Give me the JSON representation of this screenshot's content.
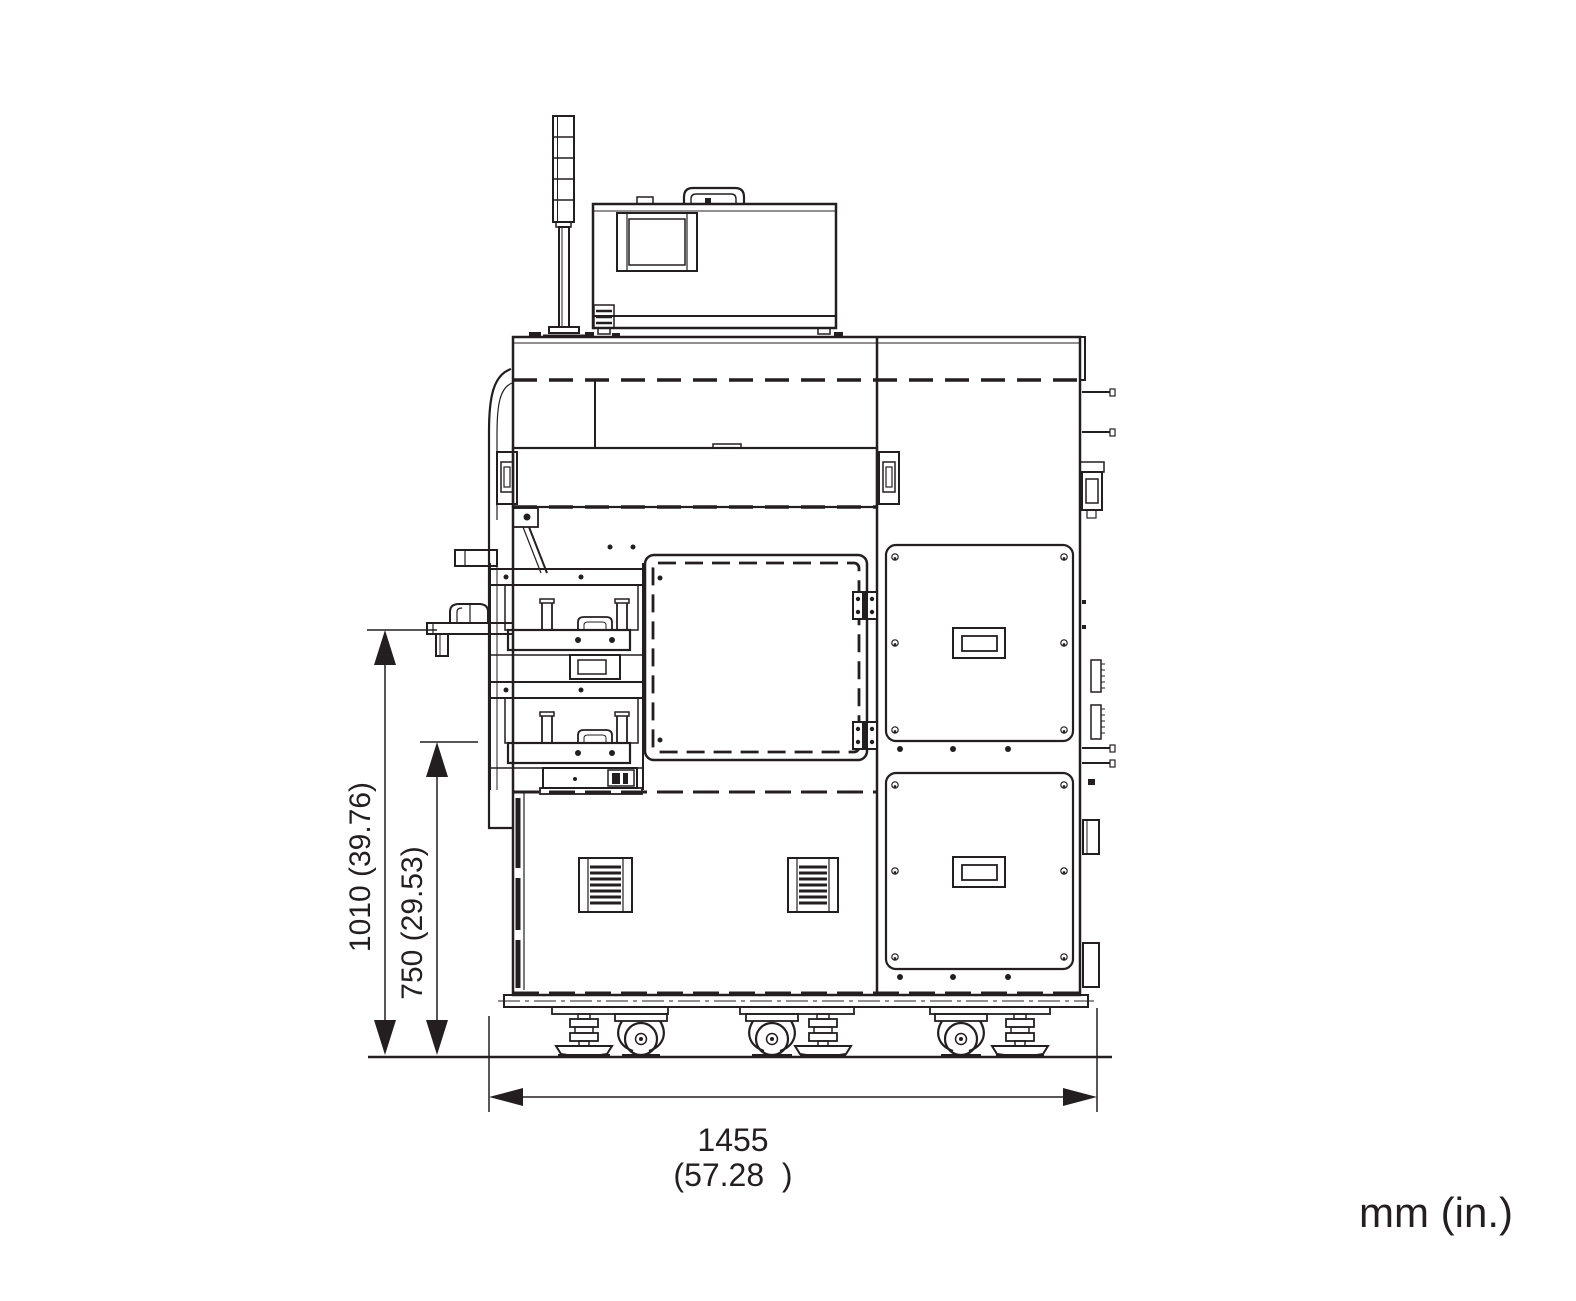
{
  "colors": {
    "line": "#231f20",
    "background": "#ffffff"
  },
  "drawing": {
    "dimensions": {
      "overall_height_label": "1010 (39.76)",
      "work_height_label": "750 (29.53)",
      "overall_width_mm": "1455",
      "overall_width_in": "(57.28  )"
    },
    "units_note": "mm (in.)"
  }
}
